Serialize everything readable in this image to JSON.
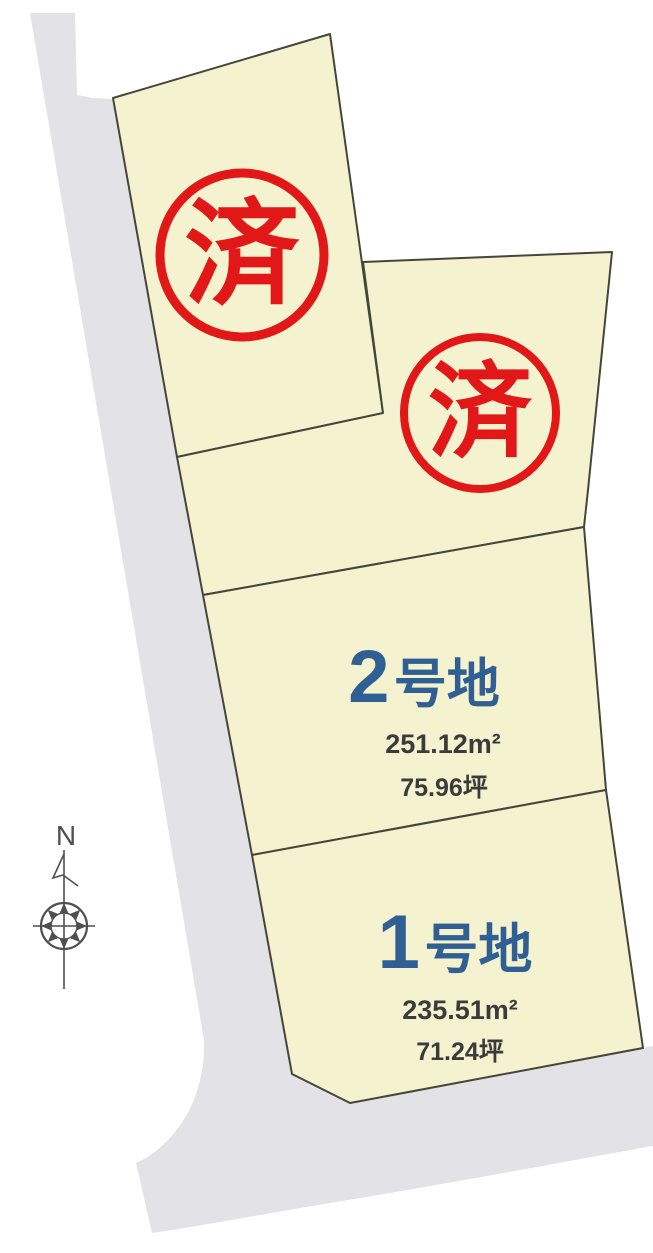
{
  "compass": {
    "north_label": "N"
  },
  "colors": {
    "plot_fill": "#f4f2cf",
    "plot_border": "#45453a",
    "road_fill": "#e3e2e7",
    "stamp_red": "#e21717",
    "plot_label_blue": "#2f5f93",
    "area_text_dark": "#3b3b3b"
  },
  "plots": [
    {
      "id": "sold-upper",
      "status_stamp": "済"
    },
    {
      "id": "sold-middle",
      "status_stamp": "済"
    },
    {
      "id": "plot-2",
      "number": "2",
      "suffix": "号地",
      "area_m2": "251.12m²",
      "area_tsubo": "75.96坪"
    },
    {
      "id": "plot-1",
      "number": "1",
      "suffix": "号地",
      "area_m2": "235.51m²",
      "area_tsubo": "71.24坪"
    }
  ]
}
